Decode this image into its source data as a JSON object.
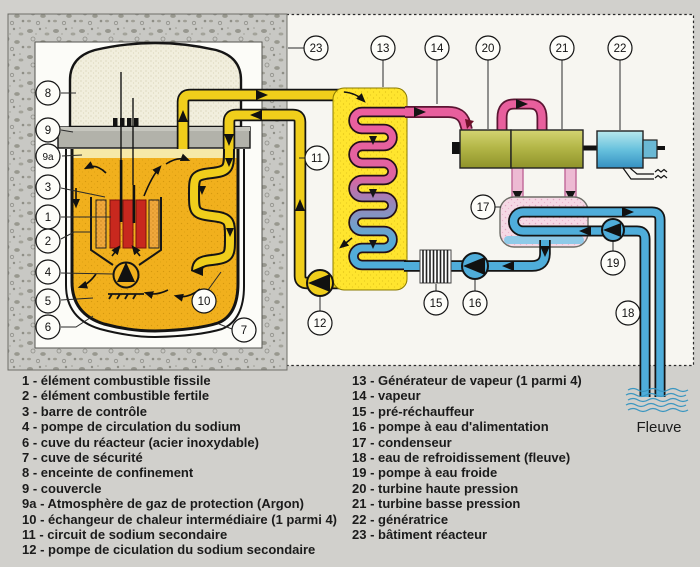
{
  "callouts": {
    "l1": "1",
    "l2": "2",
    "l3": "3",
    "l4": "4",
    "l5": "5",
    "l6": "6",
    "l7": "7",
    "l8": "8",
    "l9": "9",
    "l9a": "9a",
    "l10": "10",
    "l11": "11",
    "l12": "12",
    "l13": "13",
    "l14": "14",
    "l15": "15",
    "l16": "16",
    "l17": "17",
    "l18": "18",
    "l19": "19",
    "l20": "20",
    "l21": "21",
    "l22": "22",
    "l23": "23"
  },
  "river": {
    "label": "Fleuve"
  },
  "legend": {
    "left": [
      "1 - élément combustible fissile",
      "2 - élément combustible fertile",
      "3 - barre de contrôle",
      "4 - pompe de circulation du sodium",
      "6 - cuve du réacteur (acier inoxydable)",
      "7 - cuve de sécurité",
      "8 - enceinte de confinement",
      "9 - couvercle",
      "9a - Atmosphère de gaz de protection (Argon)",
      "10 - échangeur de chaleur intermédiaire (1 parmi 4)",
      "11 - circuit de sodium secondaire",
      "12 - pompe de ciculation du sodium secondaire"
    ],
    "right": [
      "13 - Générateur de vapeur (1 parmi 4)",
      "14 - vapeur",
      "15 - pré-réchauffeur",
      "16 - pompe à eau d'alimentation",
      "17 - condenseur",
      "18 - eau de refroidissement (fleuve)",
      "19 - pompe à eau froide",
      "20 - turbine haute pression",
      "21 - turbine basse pression",
      "22 - génératrice",
      "23 - bâtiment réacteur"
    ]
  },
  "colors": {
    "primary_sodium_orange": "#f1b01d",
    "secondary_sodium_yellow": "#f0ce1b",
    "steam_pink": "#e85f9d",
    "water_blue": "#4fadda",
    "turbine_olive": "#b2b53a",
    "generator_teal": "#6ec6dc",
    "condenser_pink": "#f5d7e4",
    "fuel_red": "#c8281e",
    "fertile_orange": "#efa73b",
    "concrete_gray": "#c7c7c3"
  }
}
